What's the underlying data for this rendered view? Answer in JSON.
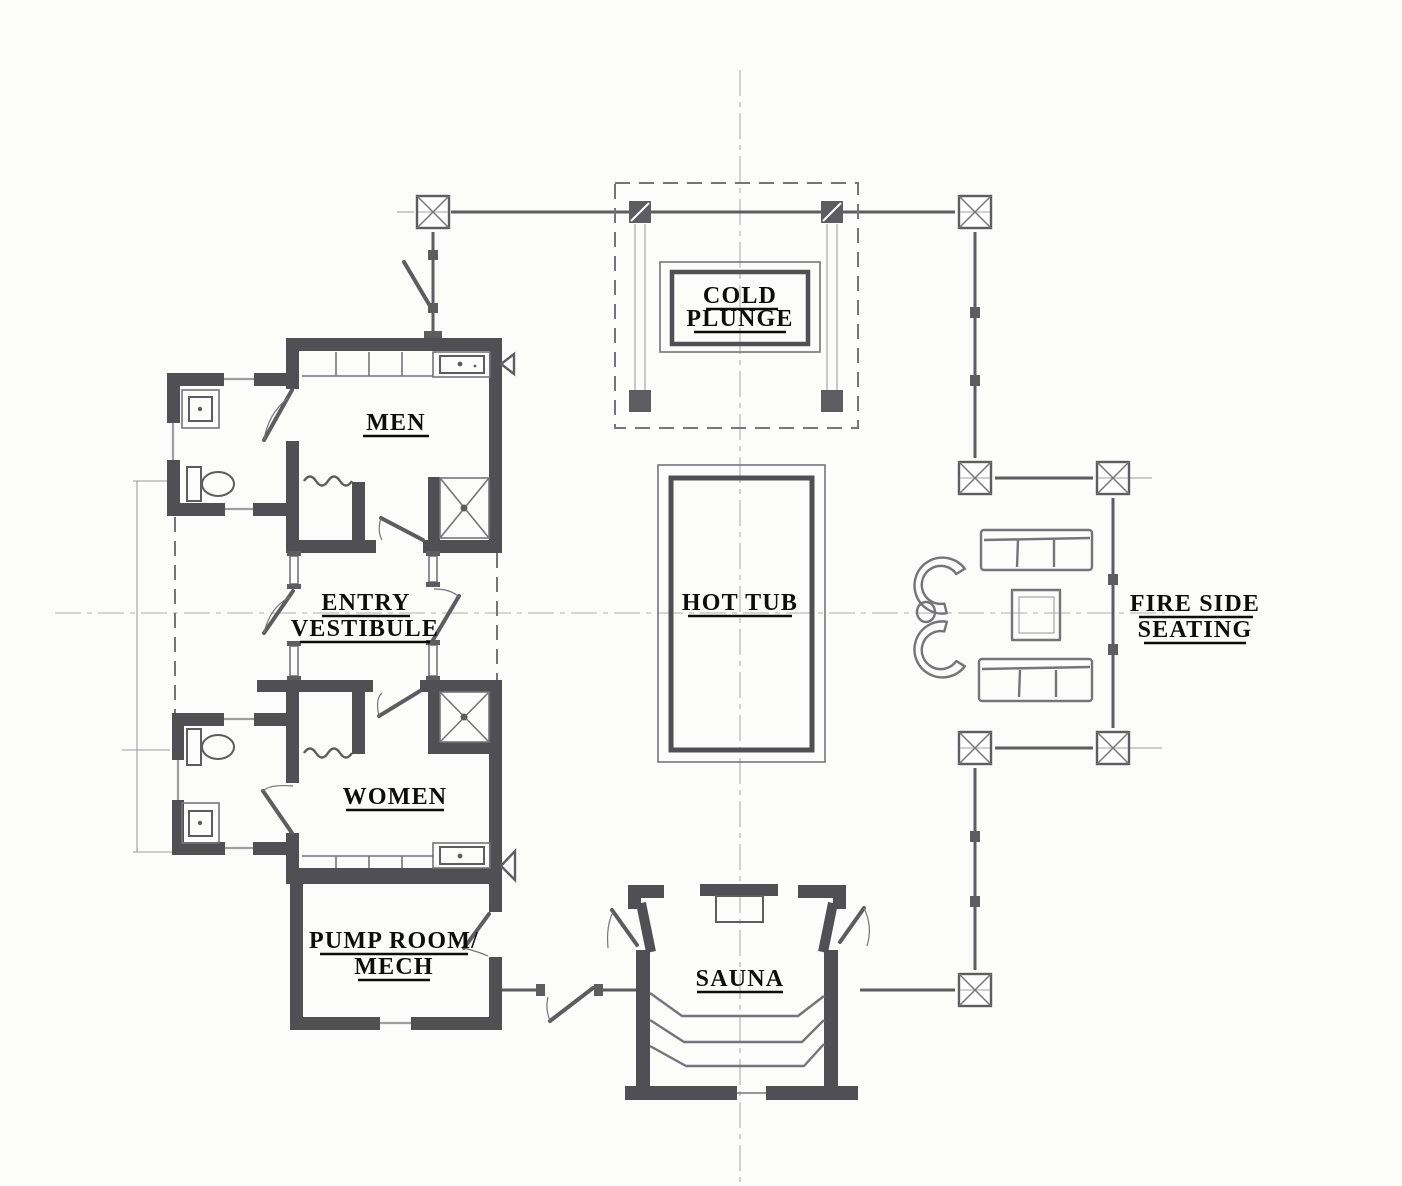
{
  "labels": {
    "cold_plunge_line1": "COLD",
    "cold_plunge_line2": "PLUNGE",
    "hot_tub": "HOT TUB",
    "men": "MEN",
    "entry_vestibule_line1": "ENTRY",
    "entry_vestibule_line2": "VESTIBULE",
    "women": "WOMEN",
    "pump_room_line1": "PUMP ROOM/",
    "pump_room_line2": "MECH",
    "sauna": "SAUNA",
    "fire_side_line1": "FIRE SIDE",
    "fire_side_line2": "SEATING"
  },
  "colors": {
    "paper": "#fcfcfa",
    "wall": "#4f4f54",
    "sketch_dark": "#5c5c61",
    "sketch_mid": "#74747a",
    "sketch_light": "#9d9da3",
    "centerline": "#b0b0b5",
    "label_text": "#0d0d0d"
  }
}
